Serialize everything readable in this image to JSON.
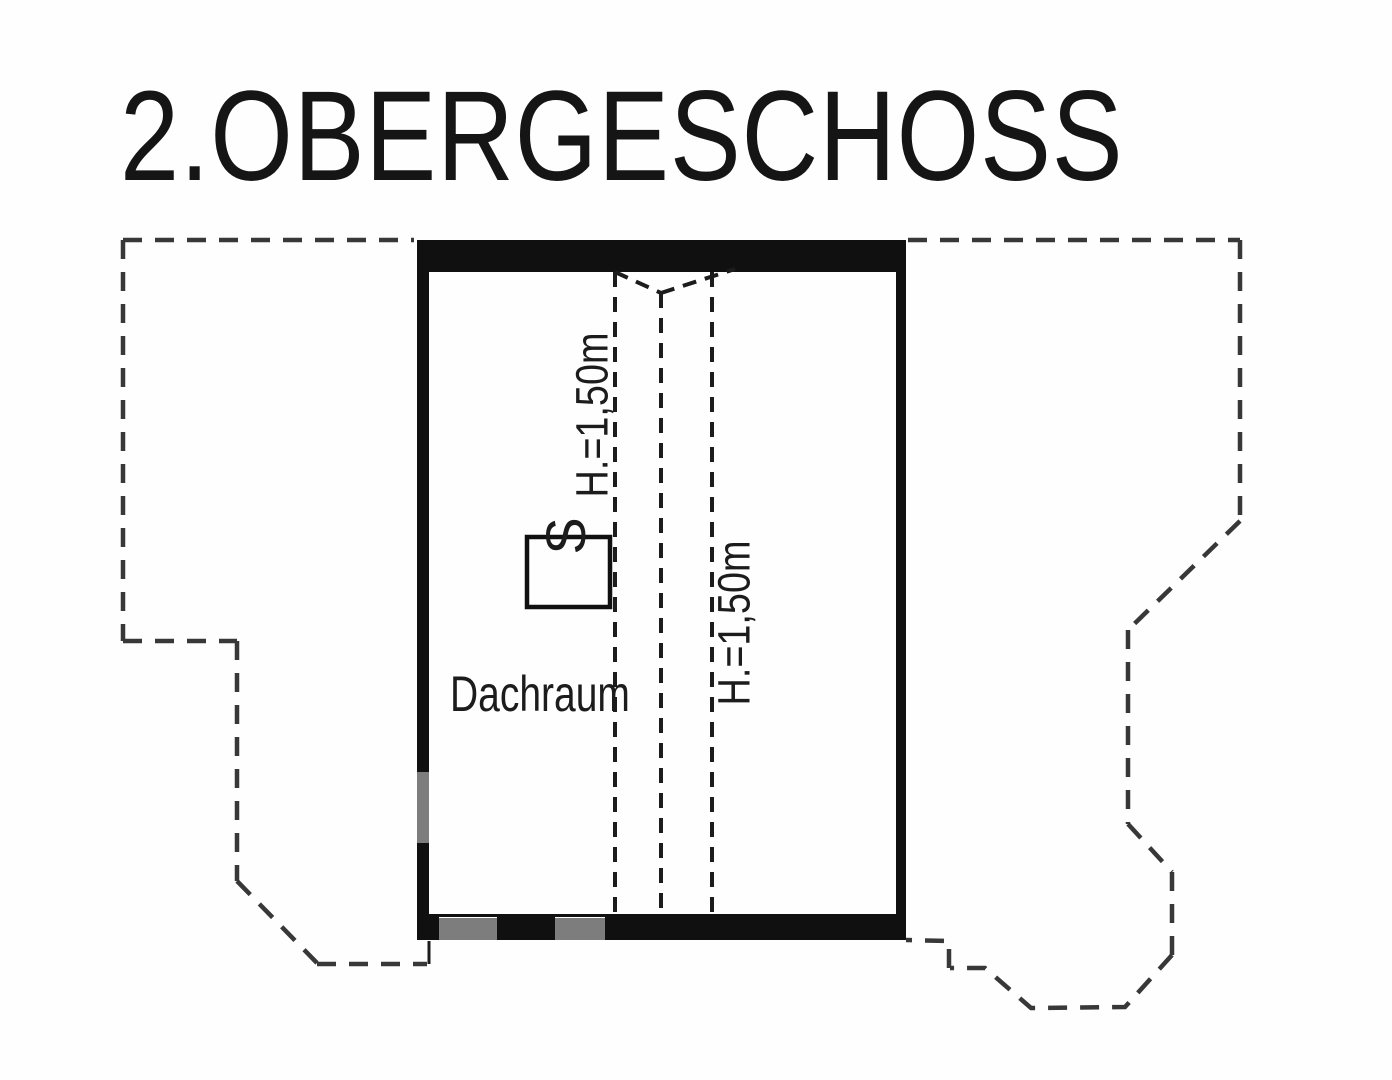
{
  "title": {
    "text": "2.OBERGESCHOSS"
  },
  "room": {
    "label": "Dachraum"
  },
  "annotations": {
    "height_left": "H.=1,50m",
    "height_right": "H.=1,50m",
    "chimney_mark": "S"
  },
  "colors": {
    "wall": "#101010",
    "wall_light": "#7d7d7d",
    "outline_dash": "#383838",
    "interior_dash": "#1c1c1c",
    "text": "#1c1c1c",
    "background": "#fefefe"
  },
  "plan": {
    "walls": [
      {
        "name": "top-wall",
        "x": 417,
        "y": 240,
        "w": 489,
        "h": 32,
        "color": "wall"
      },
      {
        "name": "right-wall",
        "x": 896,
        "y": 272,
        "w": 10,
        "h": 668,
        "color": "wall"
      },
      {
        "name": "left-wall-upper",
        "x": 417,
        "y": 242,
        "w": 12,
        "h": 530,
        "color": "wall"
      },
      {
        "name": "left-wall-opening",
        "x": 417,
        "y": 772,
        "w": 12,
        "h": 71,
        "color": "wall_light"
      },
      {
        "name": "left-wall-lower",
        "x": 417,
        "y": 843,
        "w": 12,
        "h": 75,
        "color": "wall"
      },
      {
        "name": "bottom-wall-face-line",
        "x": 429,
        "y": 914,
        "w": 467,
        "h": 3,
        "color": "wall"
      },
      {
        "name": "bottom-wall-seg-1",
        "x": 417,
        "y": 917,
        "w": 22,
        "h": 23,
        "color": "wall"
      },
      {
        "name": "bottom-wall-seg-2",
        "x": 439,
        "y": 918,
        "w": 58,
        "h": 22,
        "color": "wall_light"
      },
      {
        "name": "bottom-wall-seg-3",
        "x": 497,
        "y": 917,
        "w": 58,
        "h": 23,
        "color": "wall"
      },
      {
        "name": "bottom-wall-seg-4",
        "x": 555,
        "y": 918,
        "w": 50,
        "h": 22,
        "color": "wall_light"
      },
      {
        "name": "bottom-wall-seg-5",
        "x": 605,
        "y": 917,
        "w": 301,
        "h": 23,
        "color": "wall"
      }
    ],
    "lines": [
      {
        "name": "roof-outline-top-left",
        "points": [
          [
            123,
            240
          ],
          [
            414,
            240
          ]
        ],
        "color": "outline_dash",
        "width": 4.5,
        "dash": "19 13"
      },
      {
        "name": "roof-outline-left",
        "points": [
          [
            123,
            240
          ],
          [
            123,
            641
          ]
        ],
        "color": "outline_dash",
        "width": 4.5,
        "dash": "19 13"
      },
      {
        "name": "roof-outline-step-h",
        "points": [
          [
            123,
            641
          ],
          [
            237,
            641
          ]
        ],
        "color": "outline_dash",
        "width": 4.5,
        "dash": "19 13"
      },
      {
        "name": "roof-outline-step-v",
        "points": [
          [
            237,
            641
          ],
          [
            237,
            881
          ]
        ],
        "color": "outline_dash",
        "width": 4.5,
        "dash": "19 13"
      },
      {
        "name": "roof-outline-left-diag",
        "points": [
          [
            237,
            881
          ],
          [
            317,
            963
          ]
        ],
        "color": "outline_dash",
        "width": 4.5,
        "dash": "19 13"
      },
      {
        "name": "roof-outline-bottom-left",
        "points": [
          [
            317,
            964
          ],
          [
            427,
            964
          ]
        ],
        "color": "outline_dash",
        "width": 4.5,
        "dash": "19 13"
      },
      {
        "name": "left-outline-connector",
        "points": [
          [
            429,
            964
          ],
          [
            429,
            941
          ]
        ],
        "color": "interior_dash",
        "width": 3,
        "dash": null
      },
      {
        "name": "roof-outline-top-right",
        "points": [
          [
            908,
            240
          ],
          [
            1240,
            240
          ]
        ],
        "color": "outline_dash",
        "width": 4.5,
        "dash": "19 13"
      },
      {
        "name": "roof-outline-right-upper",
        "points": [
          [
            1240,
            240
          ],
          [
            1240,
            521
          ]
        ],
        "color": "outline_dash",
        "width": 4.5,
        "dash": "19 13"
      },
      {
        "name": "roof-outline-right-diag1",
        "points": [
          [
            1240,
            521
          ],
          [
            1128,
            630
          ]
        ],
        "color": "outline_dash",
        "width": 4.5,
        "dash": "19 13"
      },
      {
        "name": "roof-outline-right-mid",
        "points": [
          [
            1128,
            630
          ],
          [
            1128,
            824
          ]
        ],
        "color": "outline_dash",
        "width": 4.5,
        "dash": "19 13"
      },
      {
        "name": "roof-outline-right-diag2",
        "points": [
          [
            1128,
            824
          ],
          [
            1172,
            872
          ]
        ],
        "color": "outline_dash",
        "width": 4.5,
        "dash": "19 13"
      },
      {
        "name": "roof-outline-right-lower",
        "points": [
          [
            1172,
            872
          ],
          [
            1172,
            955
          ]
        ],
        "color": "outline_dash",
        "width": 4.5,
        "dash": "19 13"
      },
      {
        "name": "roof-outline-bay",
        "points": [
          [
            1172,
            955
          ],
          [
            1125,
            1007
          ],
          [
            1031,
            1008
          ],
          [
            985,
            968
          ],
          [
            950,
            968
          ]
        ],
        "color": "outline_dash",
        "width": 4.5,
        "dash": "19 13"
      },
      {
        "name": "roof-outline-bay-step",
        "points": [
          [
            949,
            968
          ],
          [
            949,
            941
          ],
          [
            906,
            940
          ]
        ],
        "color": "outline_dash",
        "width": 4.5,
        "dash": "19 13"
      },
      {
        "name": "height-line-1",
        "points": [
          [
            615,
            272
          ],
          [
            615,
            915
          ]
        ],
        "color": "interior_dash",
        "width": 4,
        "dash": "15 10"
      },
      {
        "name": "height-line-2",
        "points": [
          [
            661,
            293
          ],
          [
            661,
            915
          ]
        ],
        "color": "interior_dash",
        "width": 4,
        "dash": "15 10"
      },
      {
        "name": "height-line-3",
        "points": [
          [
            712,
            272
          ],
          [
            712,
            915
          ]
        ],
        "color": "interior_dash",
        "width": 4,
        "dash": "15 10"
      },
      {
        "name": "ridge-v-left",
        "points": [
          [
            615,
            272
          ],
          [
            661,
            293
          ]
        ],
        "color": "interior_dash",
        "width": 4,
        "dash": "14 9"
      },
      {
        "name": "ridge-v-right",
        "points": [
          [
            661,
            293
          ],
          [
            735,
            269
          ]
        ],
        "color": "interior_dash",
        "width": 4,
        "dash": "14 9"
      }
    ],
    "chimney": {
      "name": "chimney",
      "x": 527,
      "y": 537,
      "w": 83,
      "h": 70,
      "stroke_width": 4.5
    }
  }
}
